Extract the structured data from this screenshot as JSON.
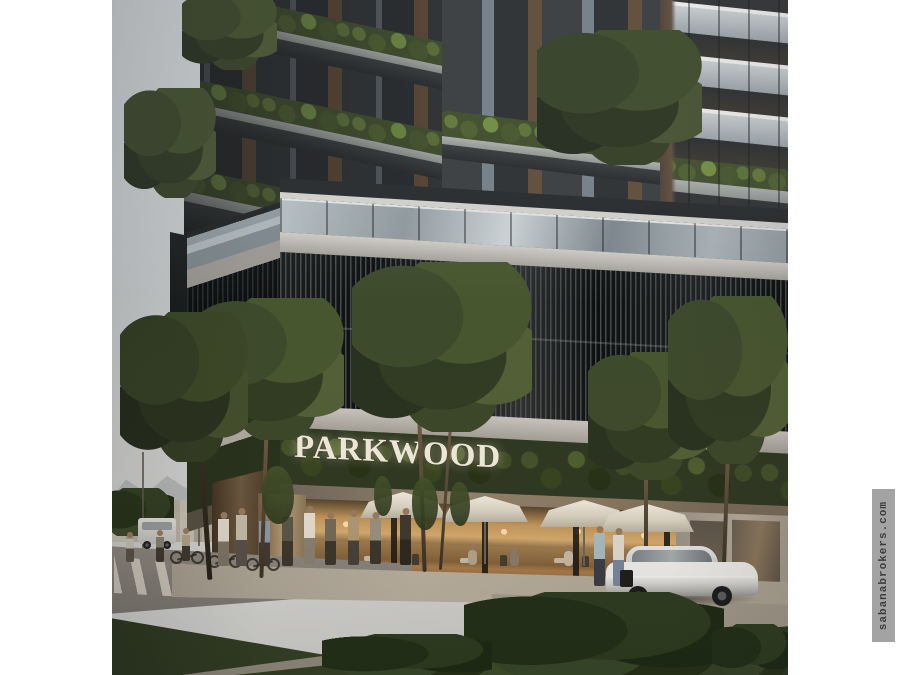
{
  "title": "PARKWOOD building rendering",
  "sign": {
    "label": "PARKWOOD",
    "color": "#f2edde"
  },
  "watermark": {
    "label": "sabanabrokers.com",
    "bg": "#a3a3a3",
    "text_color": "#3d3d3d"
  },
  "palette": {
    "sky": "#c6c9cb",
    "concrete_light": "#c9c6c0",
    "slab_dark": "#303334",
    "louver_black": "#0d0f10",
    "foliage_dark": "#2e3a22",
    "foliage_bright": "#6d8a3e",
    "wood_brown": "#6b523c",
    "cafe_glow": "#e7bd7e",
    "umbrella_white": "#f4efe4",
    "asphalt": "#8b8781",
    "sidewalk": "#b1a898",
    "grass": "#374529",
    "car_white": "#e9e9e7"
  }
}
